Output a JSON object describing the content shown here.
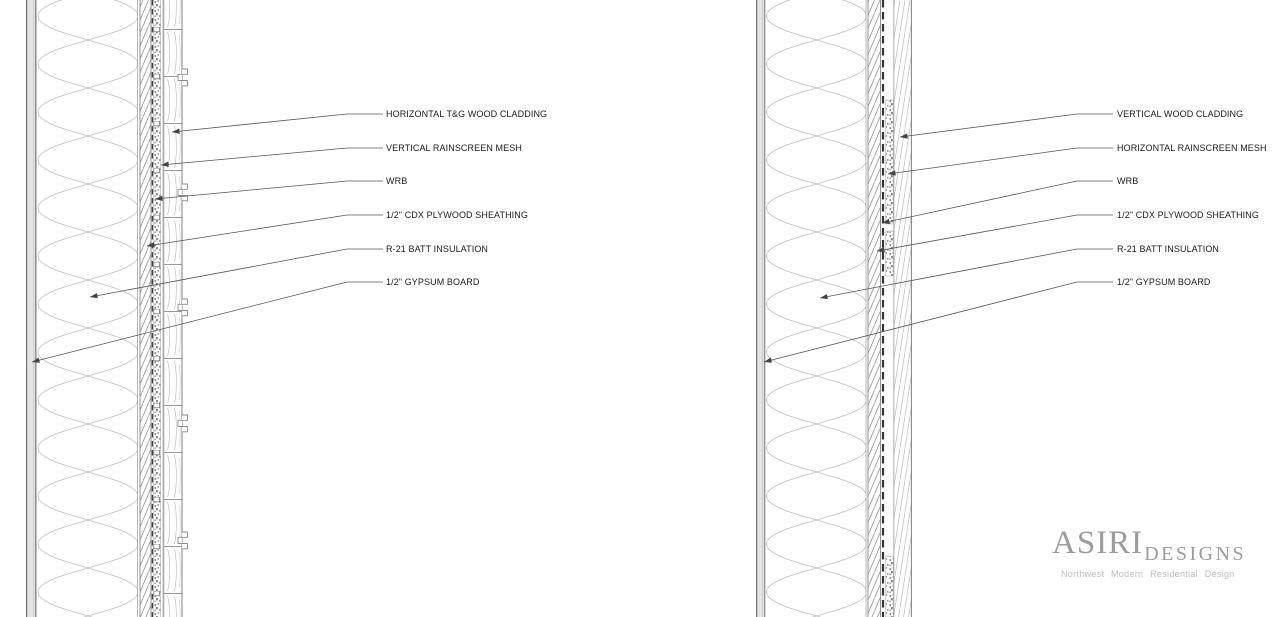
{
  "drawing": {
    "type": "architectural wall section details",
    "background": "#ffffff",
    "line_color": "#8c8c8c",
    "text_color": "#1a1a1a",
    "leader_color": "#555555"
  },
  "walls": [
    {
      "side": "left",
      "labels": [
        {
          "text": "HORIZONTAL T&G WOOD CLADDING"
        },
        {
          "text": "VERTICAL RAINSCREEN MESH"
        },
        {
          "text": "WRB"
        },
        {
          "text": "1/2\" CDX PLYWOOD SHEATHING"
        },
        {
          "text": "R-21 BATT INSULATION"
        },
        {
          "text": "1/2\" GYPSUM BOARD"
        }
      ]
    },
    {
      "side": "right",
      "labels": [
        {
          "text": "VERTICAL WOOD CLADDING"
        },
        {
          "text": "HORIZONTAL RAINSCREEN MESH"
        },
        {
          "text": "WRB"
        },
        {
          "text": "1/2\" CDX PLYWOOD SHEATHING"
        },
        {
          "text": "R-21 BATT INSULATION"
        },
        {
          "text": "1/2\" GYPSUM BOARD"
        }
      ]
    }
  ],
  "logo": {
    "brand": "ASIRI",
    "brand_suffix": "DESIGNS",
    "tagline": "Northwest  Modern  Residential  Design",
    "color": "#9c9c9c"
  }
}
